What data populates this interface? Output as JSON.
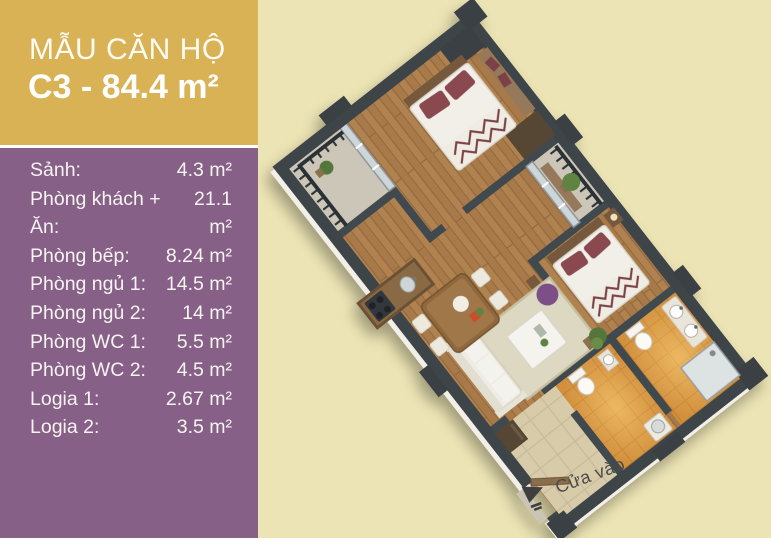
{
  "banner": {
    "title": "MẪU CĂN HỘ",
    "subtitle": "C3 - 84.4 m²"
  },
  "rooms": [
    {
      "label": "Sảnh:",
      "value": "4.3 m²"
    },
    {
      "label": "Phòng khách + Ăn:",
      "value": "21.1 m²"
    },
    {
      "label": "Phòng bếp:",
      "value": "8.24 m²"
    },
    {
      "label": "Phòng ngủ 1:",
      "value": "14.5 m²"
    },
    {
      "label": "Phòng ngủ 2:",
      "value": "14 m²"
    },
    {
      "label": "Phòng WC 1:",
      "value": "5.5 m²"
    },
    {
      "label": "Phòng WC 2:",
      "value": "4.5 m²"
    },
    {
      "label": "Logia 1:",
      "value": "2.67 m²"
    },
    {
      "label": "Logia 2:",
      "value": "3.5 m²"
    }
  ],
  "entrance": {
    "label": "Cửa vào"
  },
  "colors": {
    "banner_gold": "#d8b254",
    "panel_purple": "#866087",
    "background_cream": "#ece4b4",
    "wall_dark": "#3e454a",
    "wood_floor": "#b0824f",
    "wc_tile": "#d2903e",
    "hall_tile": "#d8cba9",
    "pouf_purple": "#7b4f86",
    "pillow_maroon": "#8a4950",
    "text_white": "#ffffff",
    "entrance_text_gray": "#4a4a4a"
  }
}
